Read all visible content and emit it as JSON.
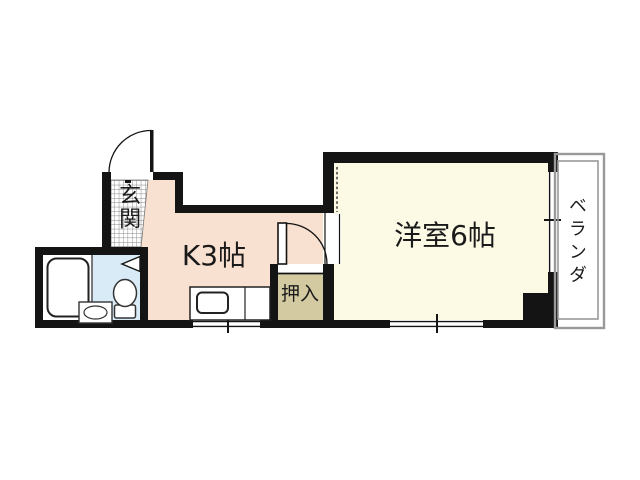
{
  "rooms": {
    "entrance": {
      "label": "玄関",
      "floor": "tile-grid"
    },
    "kitchen": {
      "label": "K3帖",
      "floor_color": "#f8e1d0"
    },
    "western_room": {
      "label": "洋室6帖",
      "floor_color": "#fcf9e5"
    },
    "closet": {
      "label": "押入",
      "floor_color": "#d4caa1"
    },
    "balcony": {
      "label": "ベランダ"
    },
    "bathroom": {
      "floor_color": "#d8ebf6"
    }
  },
  "fixtures": {
    "bathroom": [
      "bathtub",
      "toilet",
      "wash-basin",
      "folding-door-symbol"
    ],
    "kitchen": [
      "counter-with-sink"
    ],
    "doors": [
      "entrance-swing-door",
      "kitchen-to-room-swing-door"
    ],
    "windows": [
      "right-wall-window",
      "room-bottom-window",
      "kitchen-bottom-window"
    ]
  },
  "colors": {
    "wall": "#141414",
    "kitchen_floor": "#f8e1d0",
    "western_room_floor": "#fcf9e5",
    "closet_floor": "#d4caa1",
    "bathroom_floor": "#d8ebf6",
    "balcony_line": "#999999",
    "tile_grid_line": "#858585",
    "text": "#1a1a1a"
  }
}
